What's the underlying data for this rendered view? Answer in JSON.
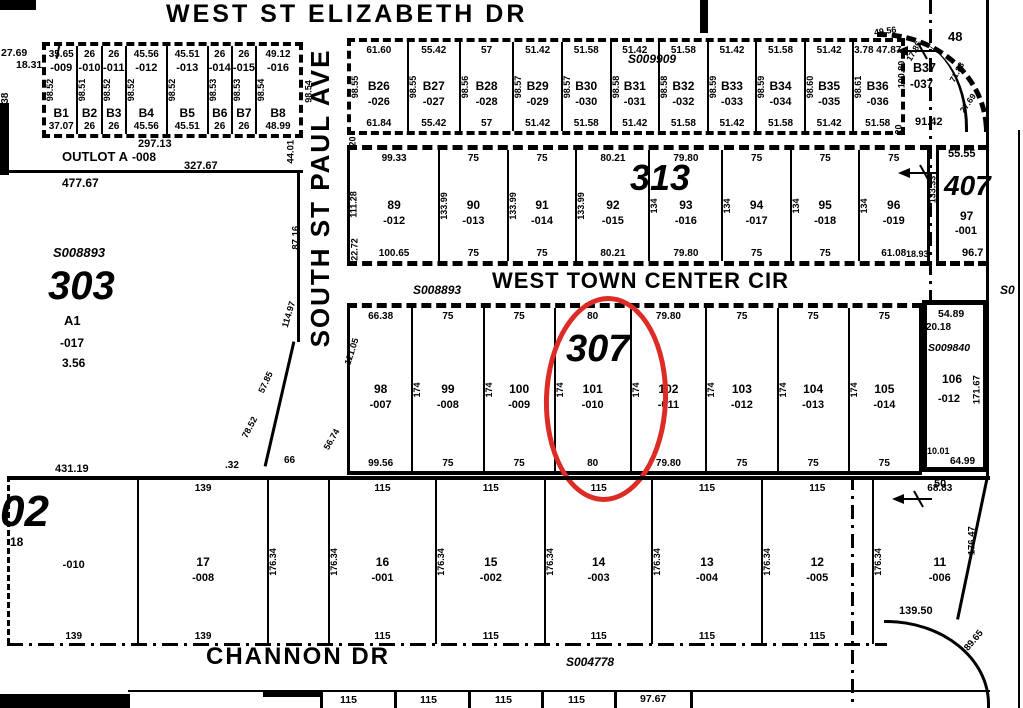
{
  "eliz": {
    "street": "WEST ST ELIZABETH DR"
  },
  "corner": {
    "d2769": "27.69",
    "d1831": "18.31",
    "d138": "138"
  },
  "bleft": {
    "lots": [
      {
        "id": "B1",
        "suffix": "-009",
        "top": "35.65",
        "bottom": "37.07",
        "side": "98.52"
      },
      {
        "id": "B2",
        "suffix": "-010",
        "top": "26",
        "bottom": "26",
        "side": "98.51"
      },
      {
        "id": "B3",
        "suffix": "-011",
        "top": "26",
        "bottom": "26",
        "side": "98.52"
      },
      {
        "id": "B4",
        "suffix": "-012",
        "top": "45.56",
        "bottom": "45.56",
        "side": "98.52"
      },
      {
        "id": "B5",
        "suffix": "-013",
        "top": "45.51",
        "bottom": "45.51",
        "side": "98.52"
      },
      {
        "id": "B6",
        "suffix": "-014",
        "top": "26",
        "bottom": "26",
        "side": "98.53"
      },
      {
        "id": "B7",
        "suffix": "-015",
        "top": "26",
        "bottom": "26",
        "side": "98.53"
      },
      {
        "id": "B8",
        "suffix": "-016",
        "top": "49.12",
        "bottom": "48.99",
        "side": "98.54"
      }
    ],
    "right98": "98.54"
  },
  "outlot": {
    "d29713": "297.13",
    "name": "OUTLOT A",
    "suffix": "-008",
    "d32767": "327.67",
    "d47767": "477.67",
    "d4401": "44.01"
  },
  "paul": {
    "street": "SOUTH ST PAUL AVE",
    "d8716": "87.16",
    "d11497": "114.97",
    "d5785": "57.85",
    "d7852": "78.52",
    "d5674": "56.74",
    "d12105": "121.05",
    "d66": "66",
    "d032": ".32",
    "w20a": "20",
    "w20b": "20"
  },
  "btop": {
    "s": "S009909",
    "lots": [
      {
        "id": "B26",
        "suffix": "-026",
        "top": "61.60",
        "bottom": "61.84",
        "side": "98.55"
      },
      {
        "id": "B27",
        "suffix": "-027",
        "top": "55.42",
        "bottom": "55.42",
        "side": "98.55"
      },
      {
        "id": "B28",
        "suffix": "-028",
        "top": "57",
        "bottom": "57",
        "side": "98.56"
      },
      {
        "id": "B29",
        "suffix": "-029",
        "top": "51.42",
        "bottom": "51.42",
        "side": "98.57"
      },
      {
        "id": "B30",
        "suffix": "-030",
        "top": "51.58",
        "bottom": "51.58",
        "side": "98.57"
      },
      {
        "id": "B31",
        "suffix": "-031",
        "top": "51.42",
        "bottom": "51.42",
        "side": "98.58"
      },
      {
        "id": "B32",
        "suffix": "-032",
        "top": "51.58",
        "bottom": "51.58",
        "side": "98.58"
      },
      {
        "id": "B33",
        "suffix": "-033",
        "top": "51.42",
        "bottom": "51.42",
        "side": "98.59"
      },
      {
        "id": "B34",
        "suffix": "-034",
        "top": "51.58",
        "bottom": "51.58",
        "side": "98.59"
      },
      {
        "id": "B35",
        "suffix": "-035",
        "top": "51.42",
        "bottom": "51.42",
        "side": "98.60"
      },
      {
        "id": "B36",
        "suffix": "-036",
        "top": "3.78 47.87",
        "bottom": "51.58",
        "side": "98.61"
      }
    ],
    "b37": {
      "id": "B37",
      "suffix": "-037",
      "d4956": "49.56",
      "d1785": "17.85",
      "d48": "48",
      "d7183": "71.83",
      "d2769": "27.69",
      "d9142": "91.42",
      "d10080": "100.80"
    }
  },
  "r313": {
    "big": "313",
    "d11128": "111.28",
    "d2272": "22.72",
    "lots": [
      {
        "id": "89",
        "suffix": "-012",
        "top": "99.33",
        "bottom": "100.65",
        "side": ""
      },
      {
        "id": "90",
        "suffix": "-013",
        "top": "75",
        "bottom": "75",
        "side": "133.99"
      },
      {
        "id": "91",
        "suffix": "-014",
        "top": "75",
        "bottom": "75",
        "side": "133.99"
      },
      {
        "id": "92",
        "suffix": "-015",
        "top": "80.21",
        "bottom": "80.21",
        "side": "133.99"
      },
      {
        "id": "93",
        "suffix": "-016",
        "top": "79.80",
        "bottom": "79.80",
        "side": "134"
      },
      {
        "id": "94",
        "suffix": "-017",
        "top": "75",
        "bottom": "75",
        "side": "134"
      },
      {
        "id": "95",
        "suffix": "-018",
        "top": "75",
        "bottom": "75",
        "side": "134"
      },
      {
        "id": "96",
        "suffix": "-019",
        "top": "75",
        "bottom": "61.08",
        "side": "134"
      }
    ]
  },
  "b407": {
    "big": "407",
    "top": "55.55",
    "lot": "97",
    "suffix": "-001",
    "bottom": "96.7",
    "side": "133.33",
    "corner": "18.93"
  },
  "tc": {
    "street": "WEST TOWN CENTER CIR",
    "s": "S008893",
    "scut": "S0"
  },
  "r307": {
    "big": "307",
    "lots": [
      {
        "id": "98",
        "suffix": "-007",
        "top": "66.38",
        "bottom": "99.56",
        "side": ""
      },
      {
        "id": "99",
        "suffix": "-008",
        "top": "75",
        "bottom": "75",
        "side": "174"
      },
      {
        "id": "100",
        "suffix": "-009",
        "top": "75",
        "bottom": "75",
        "side": "174"
      },
      {
        "id": "101",
        "suffix": "-010",
        "top": "80",
        "bottom": "80",
        "side": "174"
      },
      {
        "id": "102",
        "suffix": "-011",
        "top": "79.80",
        "bottom": "79.80",
        "side": "174"
      },
      {
        "id": "103",
        "suffix": "-012",
        "top": "75",
        "bottom": "75",
        "side": "174"
      },
      {
        "id": "104",
        "suffix": "-013",
        "top": "75",
        "bottom": "75",
        "side": "174"
      },
      {
        "id": "105",
        "suffix": "-014",
        "top": "75",
        "bottom": "75",
        "side": "174"
      }
    ]
  },
  "b106": {
    "top": "54.89",
    "d2018": "20.18",
    "s": "S009840",
    "lot": "106",
    "suffix": "-012",
    "right": "171.67",
    "d1001": "10.01",
    "bottom": "64.99"
  },
  "a303": {
    "s": "S008893",
    "big": "303",
    "a1": "A1",
    "suffix": "-017",
    "area": "3.56"
  },
  "bound": {
    "d43119": "431.19"
  },
  "rbot": {
    "big": "02",
    "d18": "18",
    "d50": "50",
    "d13950": "139.50",
    "right": "176.47",
    "curve": "89.65",
    "lots": [
      {
        "id": "",
        "suffix": "-010",
        "top": "",
        "bottom": "139",
        "side": ""
      },
      {
        "id": "17",
        "suffix": "-008",
        "top": "139",
        "bottom": "139",
        "side": ""
      },
      {
        "id": "",
        "suffix": "",
        "top": "",
        "bottom": "",
        "side": "176.34"
      },
      {
        "id": "16",
        "suffix": "-001",
        "top": "115",
        "bottom": "115",
        "side": "176.34"
      },
      {
        "id": "15",
        "suffix": "-002",
        "top": "115",
        "bottom": "115",
        "side": "176.34"
      },
      {
        "id": "14",
        "suffix": "-003",
        "top": "115",
        "bottom": "115",
        "side": "176.34"
      },
      {
        "id": "13",
        "suffix": "-004",
        "top": "115",
        "bottom": "115",
        "side": "176.34"
      },
      {
        "id": "12",
        "suffix": "-005",
        "top": "115",
        "bottom": "115",
        "side": "176.34"
      },
      {
        "id": "11",
        "suffix": "-006",
        "top": "68.83",
        "bottom": "",
        "side": "176.34"
      }
    ]
  },
  "channon": {
    "street": "CHANNON DR",
    "s": "S004778"
  },
  "brow": {
    "d1": "115",
    "d2": "115",
    "d3": "115",
    "d4": "115",
    "d5": "97.67"
  },
  "highlight": {
    "color": "#dd2b26"
  }
}
